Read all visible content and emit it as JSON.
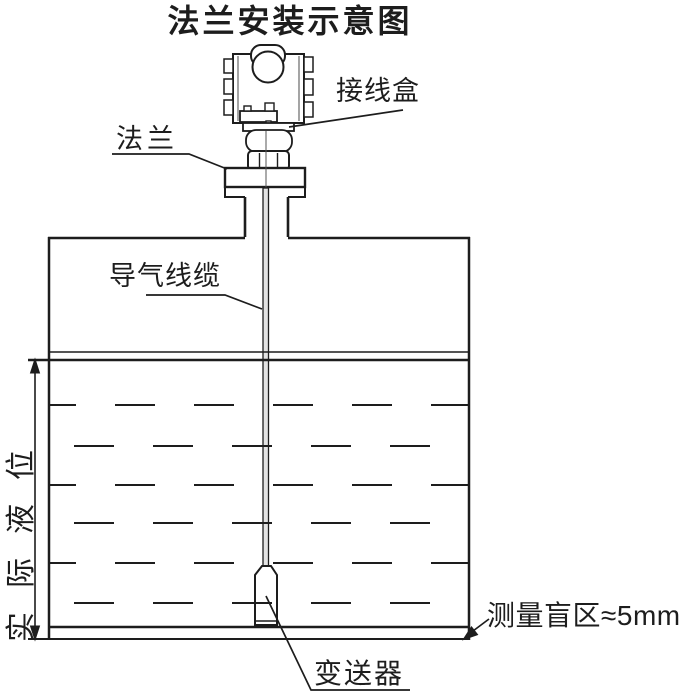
{
  "title": "法兰安装示意图",
  "labels": {
    "junction_box": "接线盒",
    "flange": "法兰",
    "air_cable": "导气线缆",
    "actual_level": "实际液位",
    "transmitter": "变送器",
    "blind_zone": "测量盲区≈5mm"
  },
  "colors": {
    "line": "#1d1d1d",
    "background": "#ffffff",
    "cable_fill": "#e3e3e3"
  }
}
